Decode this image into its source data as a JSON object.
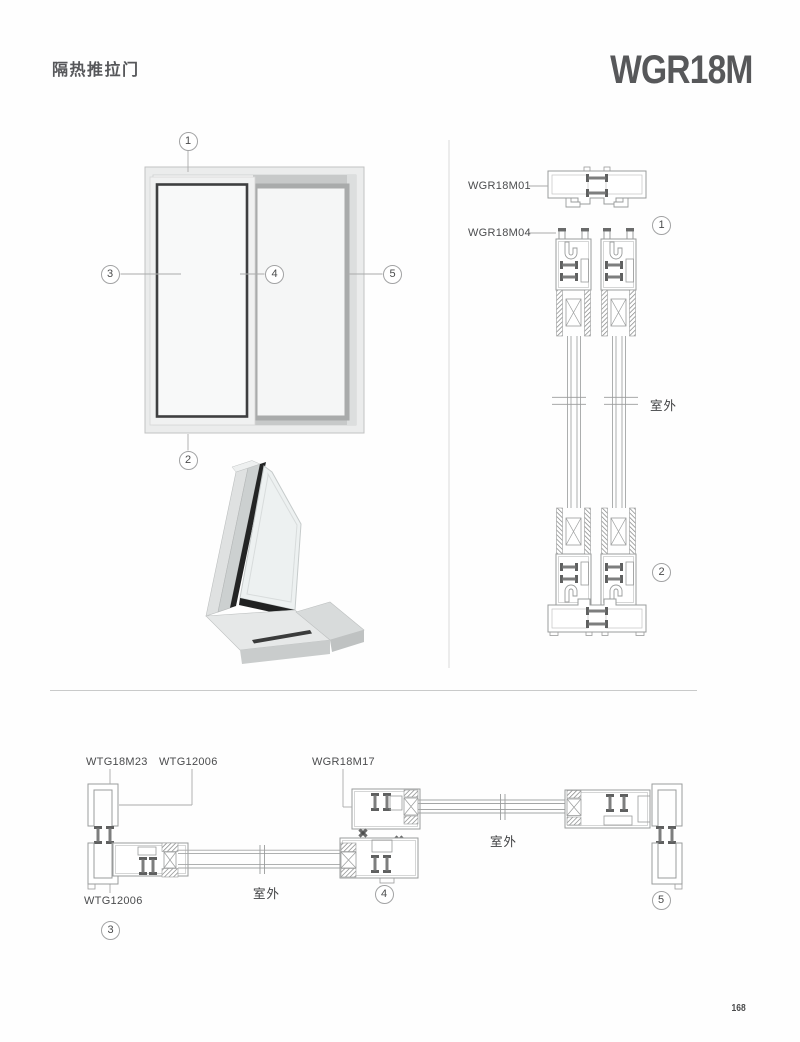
{
  "page": {
    "title": "隔热推拉门",
    "model": "WGR18M",
    "page_number": "168"
  },
  "colors": {
    "text_dark": "#57585a",
    "label": "#4b4c4e",
    "line": "#9a9c9c",
    "divider": "#cbcccc",
    "sash_dark": "#3e3f40",
    "sash_gray": "#a9abab",
    "thermal_break": "#7d7e7e"
  },
  "elevation": {
    "callouts": [
      "1",
      "2",
      "3",
      "4",
      "5"
    ]
  },
  "vertical_section": {
    "profile_labels": [
      {
        "code": "WGR18M01"
      },
      {
        "code": "WGR18M04"
      }
    ],
    "outdoor_label": "室外",
    "callouts": [
      "1",
      "2"
    ]
  },
  "horizontal_section": {
    "profile_labels": [
      {
        "code": "WTG18M23"
      },
      {
        "code": "WTG12006"
      },
      {
        "code": "WGR18M17"
      },
      {
        "code": "WTG12006"
      }
    ],
    "outdoor_label_left": "室外",
    "outdoor_label_right": "室外",
    "callouts": [
      "3",
      "4",
      "5"
    ]
  }
}
